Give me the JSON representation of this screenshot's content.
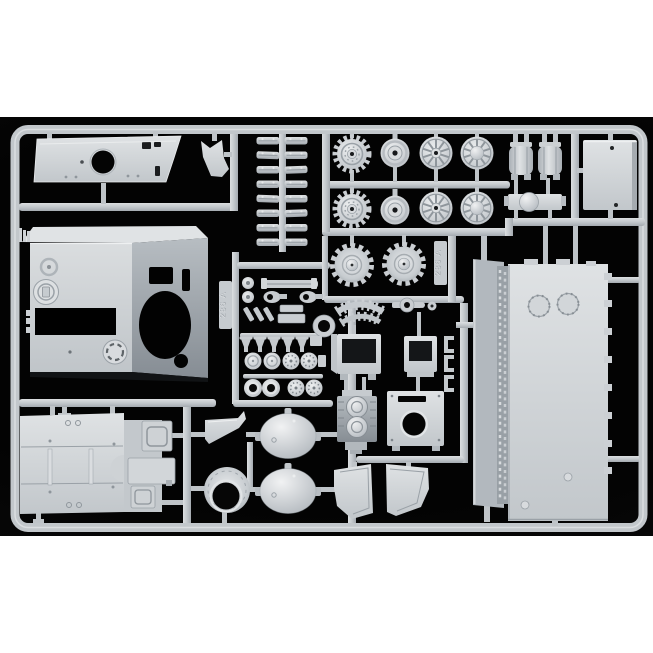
{
  "photo": {
    "subject": "Light grey injection-moulded plastic model kit sprue with tank parts, photographed on a black background with white borders above and below",
    "background_color": "#050505",
    "border_color": "#ffffff",
    "plastic_base_color": "#c9cdd1",
    "plastic_highlight_color": "#e9ebed",
    "plastic_shadow_color": "#8f969c",
    "sprue_tags": [
      {
        "label": "286 A"
      },
      {
        "label": "286 A"
      }
    ],
    "parts": [
      "hull roof plate with round opening",
      "fin bracket",
      "stack of track links",
      "toothed drive sprocket wheels",
      "idler wheels",
      "spoked road wheels",
      "domed road wheels",
      "dished sprocket halves",
      "fuel tanks with straps",
      "rectangular roof hatch panel",
      "bracket with domed boss",
      "superstructure box with gun opening",
      "engine deck panel with hatches",
      "wing bracket",
      "collar housing with central bore",
      "armoured domes",
      "engine block with twin filters",
      "mounting plate with circular hole",
      "open stowage boxes",
      "retaining clips",
      "narrow hull side panel",
      "hull bottom panel with bolted hatches",
      "curved mudguards",
      "curved toothed track sections",
      "assorted small fittings, caps and rings"
    ]
  }
}
